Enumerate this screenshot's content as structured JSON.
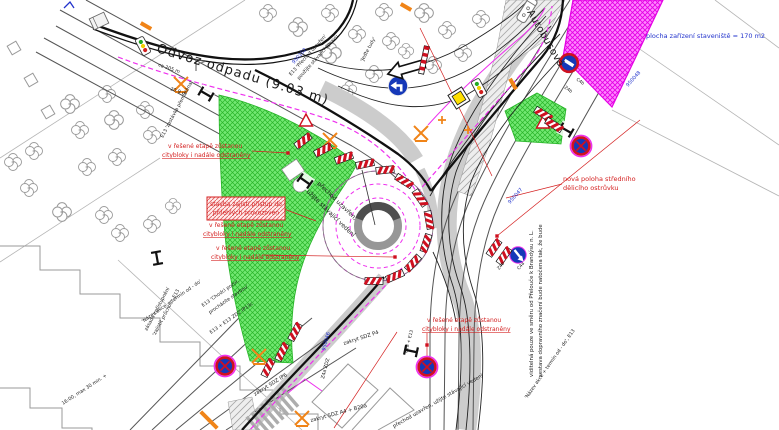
{
  "palette": {
    "background": "#ffffff",
    "ink": "#1a1a1a",
    "red": "#d42020",
    "blue": "#2233cc",
    "magenta": "#ee30ee",
    "green_fill": "#72e872",
    "green_hatch": "#28b428",
    "orange": "#f08418",
    "sign_blue": "#1538b8",
    "sign_red": "#cf1020",
    "road_gray": "#555555",
    "light_gray": "#b5b5b5"
  },
  "labels": [
    {
      "id": "road-name-top",
      "t": "Odvoz odpadu (9.03 m)",
      "x": 156,
      "y": 52,
      "r": 17,
      "s": 13,
      "c": "ink",
      "ls": 1.2
    },
    {
      "id": "street-name-right",
      "t": "Autobusová",
      "x": 527,
      "y": 12,
      "r": 60,
      "s": 10,
      "c": "ink",
      "ls": 0.5
    },
    {
      "id": "staging-area-note",
      "t": "plocha zařízení staveniště = 170 m2",
      "x": 646,
      "y": 38,
      "r": 0,
      "s": 6.5,
      "c": "blue"
    },
    {
      "id": "island-note-1",
      "t": "nová poloha středního",
      "x": 563,
      "y": 181,
      "r": 0,
      "s": 6.5,
      "c": "red"
    },
    {
      "id": "island-note-2",
      "t": "dělicího ostrůvku",
      "x": 563,
      "y": 190,
      "r": 0,
      "s": 6.5,
      "c": "red"
    },
    {
      "id": "stage-a-1",
      "t": "v řešené etapě zůstanou",
      "x": 168,
      "y": 148,
      "r": 0,
      "s": 6,
      "c": "red"
    },
    {
      "id": "stage-a-2",
      "t": "citybloky i nadále odstraněny",
      "x": 162,
      "y": 157,
      "r": 0,
      "s": 6,
      "c": "red",
      "u": 1
    },
    {
      "id": "stage-b-1",
      "t": "v řešené etapě zůstanou",
      "x": 209,
      "y": 227,
      "r": 0,
      "s": 6,
      "c": "red"
    },
    {
      "id": "stage-b-2",
      "t": "citybloky i nadále odstraněny",
      "x": 203,
      "y": 236,
      "r": 0,
      "s": 6,
      "c": "red",
      "u": 1
    },
    {
      "id": "stage-c-1",
      "t": "v řešené etapě zůstanou",
      "x": 216,
      "y": 250,
      "r": 0,
      "s": 6,
      "c": "red"
    },
    {
      "id": "stage-c-2",
      "t": "citybloky i nadále odstraněny",
      "x": 211,
      "y": 259,
      "r": 0,
      "s": 6,
      "c": "red",
      "u": 1
    },
    {
      "id": "stage-d-1",
      "t": "v řešené etapě zůstanou",
      "x": 427,
      "y": 322,
      "r": 0,
      "s": 6,
      "c": "red"
    },
    {
      "id": "stage-d-2",
      "t": "citybloky i nadále odstraněny",
      "x": 422,
      "y": 331,
      "r": 0,
      "s": 6,
      "c": "red",
      "u": 1
    },
    {
      "id": "access-box-1",
      "t": "stavba zajistí přístup do",
      "x": 246,
      "y": 206,
      "r": 0,
      "s": 6,
      "c": "red",
      "a": "middle"
    },
    {
      "id": "access-box-2",
      "t": "přilehlých provozoven",
      "x": 246,
      "y": 214.5,
      "r": 0,
      "s": 6,
      "c": "red",
      "a": "middle"
    },
    {
      "id": "crossing-closed-1",
      "t": "přechod uzavřen,",
      "x": 317,
      "y": 184,
      "r": 44,
      "s": 6,
      "c": "ink"
    },
    {
      "id": "crossing-closed-2",
      "t": "užijte stávající vedení",
      "x": 306,
      "y": 192,
      "r": 44,
      "s": 6,
      "c": "ink"
    },
    {
      "id": "crossing-closed-3",
      "t": "přechod uzavřen, užijte stávající vedení",
      "x": 394,
      "y": 428,
      "r": -30,
      "s": 5.2,
      "c": "ink"
    },
    {
      "id": "rotate-note-1",
      "t": "sestava dopravního značení bude natočena tak, že bude",
      "x": 542,
      "y": 377,
      "r": -90,
      "s": 5.4,
      "c": "ink"
    },
    {
      "id": "rotate-note-2",
      "t": "viditelná pouze ve směru od Přelouče k Brandýsu n. L.",
      "x": 533,
      "y": 377,
      "r": -90,
      "s": 5.4,
      "c": "ink"
    },
    {
      "id": "e13-crossing-1",
      "t": "E13 'Přechod uzavřen'",
      "x": 291,
      "y": 76,
      "r": -48,
      "s": 4.8,
      "c": "ink"
    },
    {
      "id": "e13-crossing-2",
      "t": "použijte stávající úpravu",
      "x": 299,
      "y": 80,
      "r": -48,
      "s": 4.8,
      "c": "ink"
    },
    {
      "id": "dim-205",
      "t": "ca 205 m",
      "x": 158,
      "y": 66,
      "r": 19,
      "s": 4.8,
      "c": "ink"
    },
    {
      "id": "dim-209",
      "t": "20.9 m",
      "x": 170,
      "y": 90,
      "r": 19,
      "s": 4.8,
      "c": "ink"
    },
    {
      "id": "stop-moved",
      "t": "E13 'zastávka přemístěna'",
      "x": 163,
      "y": 138,
      "r": -62,
      "s": 4.8,
      "c": "ink"
    },
    {
      "id": "jedte-tudy",
      "t": "'Jeďte tudy'",
      "x": 363,
      "y": 62,
      "r": -62,
      "s": 4.8,
      "c": "ink"
    },
    {
      "id": "access-note-1",
      "t": "zásada zpřístupnění",
      "x": 147,
      "y": 331,
      "r": -62,
      "s": 4.8,
      "c": "ink"
    },
    {
      "id": "access-note-2",
      "t": "'zajistit průchod', E13",
      "x": 155,
      "y": 336,
      "r": -62,
      "s": 4.8,
      "c": "ink"
    },
    {
      "id": "chodci-1",
      "t": "E13 'Chodci pozor,",
      "x": 203,
      "y": 307,
      "r": -35,
      "s": 4.8,
      "c": "ink"
    },
    {
      "id": "chodci-2",
      "t": "procházíte stavbou'",
      "x": 210,
      "y": 314,
      "r": -35,
      "s": 4.8,
      "c": "ink"
    },
    {
      "id": "e13-zdz",
      "t": "E13 + E13 ZDZ IP13c",
      "x": 211,
      "y": 334,
      "r": -35,
      "s": 4.8,
      "c": "ink"
    },
    {
      "id": "nazev-akce-1",
      "t": "'Název akce + termín od - do'",
      "x": 143,
      "y": 323,
      "r": -35,
      "s": 4.8,
      "c": "ink"
    },
    {
      "id": "nazev-akce-2",
      "t": "'Název akce + termín od - do', E13",
      "x": 527,
      "y": 399,
      "r": -55,
      "s": 4.8,
      "c": "ink"
    },
    {
      "id": "zakryt-p4",
      "t": "zakryt SDZ P4",
      "x": 344,
      "y": 345,
      "r": -18,
      "s": 5.2,
      "c": "ink"
    },
    {
      "id": "zakryt-ip6",
      "t": "zakryt SDZ IP6",
      "x": 255,
      "y": 396,
      "r": -32,
      "s": 5.2,
      "c": "ink"
    },
    {
      "id": "zakryt-a4",
      "t": "zakryt SDZ A4 + B20a",
      "x": 311,
      "y": 422,
      "r": -15,
      "s": 5.2,
      "c": "ink"
    },
    {
      "id": "z4a-zdz",
      "t": "Z4a ZDZ",
      "x": 324,
      "y": 379,
      "r": -75,
      "s": 4.8,
      "c": "ink"
    },
    {
      "id": "time-note",
      "t": "16:00, max 30 min. +",
      "x": 63,
      "y": 405,
      "r": -33,
      "s": 4.8,
      "c": "ink"
    },
    {
      "id": "id-950102",
      "t": "950102",
      "x": 294,
      "y": 64,
      "r": -48,
      "s": 5,
      "c": "blue"
    },
    {
      "id": "id-950047",
      "t": "950047",
      "x": 510,
      "y": 204,
      "r": -48,
      "s": 5,
      "c": "blue"
    },
    {
      "id": "id-950048",
      "t": "950048",
      "x": 628,
      "y": 87,
      "r": -48,
      "s": 5,
      "c": "blue"
    },
    {
      "id": "id-950046",
      "t": "950046",
      "x": 325,
      "y": 351,
      "r": -75,
      "s": 5,
      "c": "blue"
    },
    {
      "id": "code-c4b",
      "t": "C4b",
      "x": 576,
      "y": 80,
      "r": 35,
      "s": 4.4,
      "c": "ink"
    },
    {
      "id": "code-z4b-top",
      "t": "Z4b",
      "x": 564,
      "y": 88,
      "r": 35,
      "s": 4.4,
      "c": "ink"
    },
    {
      "id": "code-c4a",
      "t": "C4a",
      "x": 519,
      "y": 270,
      "r": -50,
      "s": 4.4,
      "c": "ink"
    },
    {
      "id": "code-z4b-mid",
      "t": "Z4b",
      "x": 499,
      "y": 270,
      "r": -50,
      "s": 4.4,
      "c": "ink"
    },
    {
      "id": "code-b28-e13",
      "t": "B28 + E13",
      "x": 407,
      "y": 353,
      "r": -75,
      "s": 4.4,
      "c": "ink"
    }
  ],
  "signs": [
    {
      "type": "traffic_light",
      "x": 143,
      "y": 46,
      "r": -28
    },
    {
      "type": "traffic_light",
      "x": 479,
      "y": 88,
      "r": -28
    },
    {
      "type": "no_stopping",
      "x": 581,
      "y": 146,
      "r": 0
    },
    {
      "type": "no_stopping",
      "x": 225,
      "y": 366,
      "r": 0
    },
    {
      "type": "no_stopping",
      "x": 427,
      "y": 367,
      "r": 0
    },
    {
      "type": "no_entry_bar",
      "x": 569,
      "y": 63,
      "r": 32
    },
    {
      "type": "turn_arrow",
      "x": 398,
      "y": 86,
      "r": 0
    },
    {
      "type": "bypass_arrow",
      "x": 518,
      "y": 255,
      "r": 0
    },
    {
      "type": "big_arrow",
      "x": 409,
      "y": 68,
      "r": -16
    },
    {
      "type": "striped_pole",
      "x": 424,
      "y": 60,
      "r": 12
    },
    {
      "type": "yellow_panel",
      "x": 459,
      "y": 98,
      "r": -32
    },
    {
      "type": "bus",
      "x": 527,
      "y": 10,
      "r": -58
    },
    {
      "type": "flag",
      "x": 196,
      "y": 71,
      "r": 0
    },
    {
      "type": "ibeam",
      "x": 206,
      "y": 94,
      "r": -60
    },
    {
      "type": "ibeam",
      "x": 157,
      "y": 258,
      "r": -10
    },
    {
      "type": "ibeam",
      "x": 305,
      "y": 181,
      "r": -55
    },
    {
      "type": "ibeam",
      "x": 566,
      "y": 130,
      "r": -60
    },
    {
      "type": "ibeam",
      "x": 411,
      "y": 351,
      "r": -78
    },
    {
      "type": "orange_x",
      "x": 181,
      "y": 84,
      "r": 0
    },
    {
      "type": "orange_x",
      "x": 330,
      "y": 140,
      "r": 0
    },
    {
      "type": "orange_x",
      "x": 421,
      "y": 133,
      "r": 0
    },
    {
      "type": "orange_x",
      "x": 259,
      "y": 356,
      "r": 0
    },
    {
      "type": "orange_x",
      "x": 302,
      "y": 418,
      "r": 0
    },
    {
      "type": "orange_bar",
      "x": 146,
      "y": 26,
      "r": 30
    },
    {
      "type": "orange_bar",
      "x": 513,
      "y": 84,
      "r": 60
    },
    {
      "type": "orange_bar",
      "x": 406,
      "y": 7,
      "r": 30
    },
    {
      "type": "orange_bar",
      "x": 205,
      "y": 416,
      "r": 45
    },
    {
      "type": "orange_bar",
      "x": 213,
      "y": 424,
      "r": 45
    },
    {
      "type": "orange_plus",
      "x": 442,
      "y": 120,
      "r": 0
    },
    {
      "type": "orange_plus",
      "x": 468,
      "y": 130,
      "r": 0
    },
    {
      "type": "red_triangle",
      "x": 306,
      "y": 121,
      "r": 0
    },
    {
      "type": "red_triangle",
      "x": 543,
      "y": 123,
      "r": 0
    },
    {
      "type": "red_dot",
      "x": 288,
      "y": 153,
      "r": 0
    },
    {
      "type": "red_dot",
      "x": 395,
      "y": 257,
      "r": 0
    },
    {
      "type": "red_dot",
      "x": 427,
      "y": 345,
      "r": 0
    },
    {
      "type": "red_dot",
      "x": 497,
      "y": 236,
      "r": 0
    },
    {
      "type": "blue_mark",
      "x": 68,
      "y": 3,
      "r": 0
    },
    {
      "type": "kiosk",
      "x": 99,
      "y": 21,
      "r": -25
    },
    {
      "type": "z4_board",
      "x": 303,
      "y": 141,
      "r": -38
    },
    {
      "type": "z4_board",
      "x": 323,
      "y": 150,
      "r": -28
    },
    {
      "type": "z4_board",
      "x": 344,
      "y": 158,
      "r": -20
    },
    {
      "type": "z4_board",
      "x": 365,
      "y": 164,
      "r": -12
    },
    {
      "type": "z4_board",
      "x": 385,
      "y": 170,
      "r": -6
    },
    {
      "type": "z4_board",
      "x": 404,
      "y": 181,
      "r": 32
    },
    {
      "type": "z4_board",
      "x": 420,
      "y": 198,
      "r": 55
    },
    {
      "type": "z4_board",
      "x": 429,
      "y": 220,
      "r": 80
    },
    {
      "type": "z4_board",
      "x": 426,
      "y": 243,
      "r": 108
    },
    {
      "type": "z4_board",
      "x": 413,
      "y": 263,
      "r": 132
    },
    {
      "type": "z4_board",
      "x": 395,
      "y": 276,
      "r": 156
    },
    {
      "type": "z4_board",
      "x": 374,
      "y": 281,
      "r": 180
    },
    {
      "type": "z4_board",
      "x": 295,
      "y": 332,
      "r": -62
    },
    {
      "type": "z4_board",
      "x": 282,
      "y": 352,
      "r": -63
    },
    {
      "type": "z4_board",
      "x": 268,
      "y": 368,
      "r": -64
    },
    {
      "type": "z4_board",
      "x": 543,
      "y": 114,
      "r": 32
    },
    {
      "type": "z4_board",
      "x": 554,
      "y": 125,
      "r": 32
    },
    {
      "type": "z4_board",
      "x": 494,
      "y": 248,
      "r": -55
    },
    {
      "type": "z4_board",
      "x": 504,
      "y": 256,
      "r": -55
    }
  ],
  "trees": [
    [
      13,
      162,
      1
    ],
    [
      34,
      151,
      1
    ],
    [
      29,
      188,
      1
    ],
    [
      70,
      104,
      1.1
    ],
    [
      80,
      130,
      1
    ],
    [
      107,
      94,
      1
    ],
    [
      114,
      120,
      1.1
    ],
    [
      145,
      110,
      1
    ],
    [
      152,
      135,
      1
    ],
    [
      117,
      157,
      1
    ],
    [
      87,
      167,
      1
    ],
    [
      62,
      212,
      1.1
    ],
    [
      104,
      215,
      1
    ],
    [
      120,
      233,
      1
    ],
    [
      152,
      224,
      1
    ],
    [
      173,
      206,
      0.9
    ],
    [
      268,
      13,
      1
    ],
    [
      298,
      27,
      1.1
    ],
    [
      330,
      13,
      1
    ],
    [
      331,
      53,
      1.2
    ],
    [
      357,
      34,
      1
    ],
    [
      384,
      12,
      1
    ],
    [
      391,
      41,
      1
    ],
    [
      424,
      13,
      1.1
    ],
    [
      447,
      30,
      1
    ],
    [
      463,
      53,
      1
    ],
    [
      481,
      19,
      1
    ],
    [
      512,
      8,
      0.9
    ],
    [
      433,
      65,
      1
    ],
    [
      406,
      51,
      0.9
    ],
    [
      374,
      74,
      1
    ],
    [
      349,
      89,
      0.9
    ]
  ]
}
